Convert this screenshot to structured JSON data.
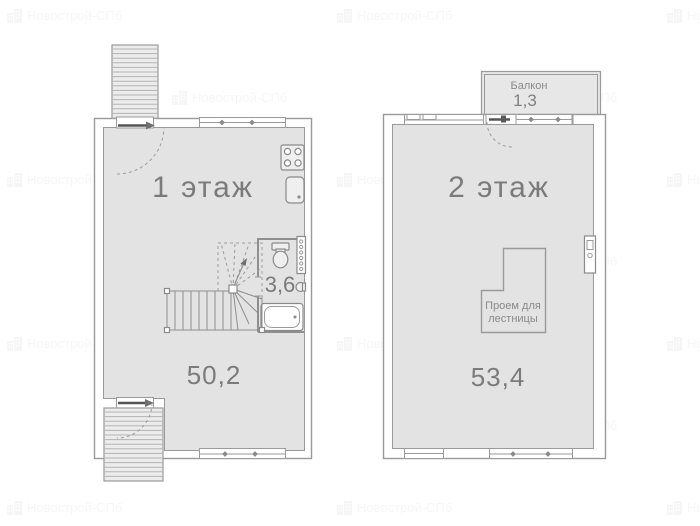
{
  "watermark": {
    "text": "Новострой-СПб",
    "icon": "building-icon"
  },
  "floor1": {
    "title": "1 этаж",
    "area": "50,2",
    "bathroom_area": "3,6"
  },
  "floor2": {
    "title": "2 этаж",
    "area": "53,4",
    "balcony": {
      "label": "Балкон",
      "area": "1,3"
    },
    "stair_opening": {
      "line1": "Проем для",
      "line2": "лестницы"
    }
  },
  "colors": {
    "floor_fill": "#e3e3e3",
    "wall_stroke": "#9a9a9a",
    "label_text": "#7b7b7b",
    "watermark_color": "#8c8c8c"
  }
}
